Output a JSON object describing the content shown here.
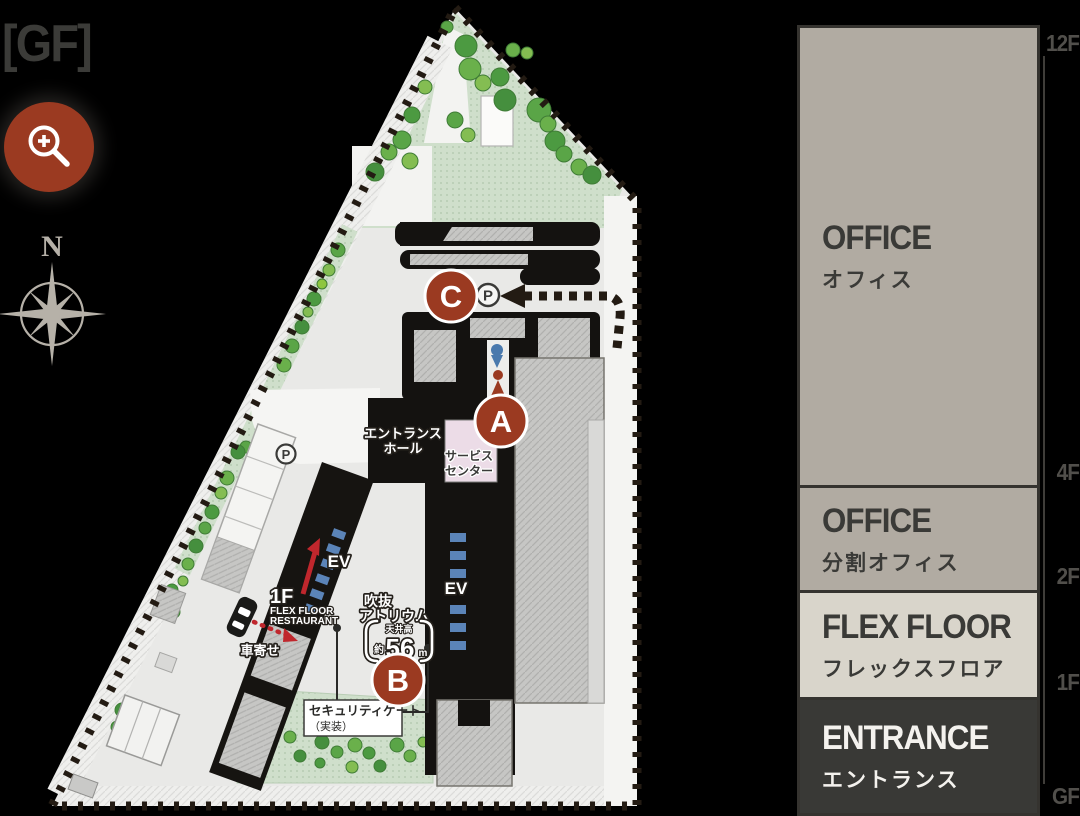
{
  "page": {
    "title": "[GF]"
  },
  "controls": {
    "zoom_button_icon": "magnifier-plus-icon",
    "compass_north": "N"
  },
  "map": {
    "markers": [
      {
        "label": "C"
      },
      {
        "label": "A"
      },
      {
        "label": "B"
      }
    ],
    "parking": {
      "north": "P",
      "west": "P"
    },
    "labels": {
      "entrance_hall_line1": "エントランス",
      "entrance_hall_line2": "ホール",
      "service_center_line1": "サービス",
      "service_center_line2": "センター",
      "ev_left": "EV",
      "ev_right": "EV",
      "restaurant_floor": "1F",
      "restaurant_line1": "FLEX FLOOR",
      "restaurant_line2": "RESTAURANT",
      "atrium_line1": "吹抜",
      "atrium_line2": "アトリウム",
      "ceiling_caption": "天井高",
      "ceiling_prefix": "約",
      "ceiling_value": "56",
      "ceiling_unit": "m",
      "car_drop": "車寄せ",
      "security_gate_line1": "セキュリティゲート",
      "security_gate_line2": "（実装）"
    }
  },
  "sidebar": {
    "floors": [
      {
        "en": "OFFICE",
        "ja": "オフィス"
      },
      {
        "en": "OFFICE",
        "ja": "分割オフィス"
      },
      {
        "en": "FLEX FLOOR",
        "ja": "フレックスフロア"
      },
      {
        "en": "ENTRANCE",
        "ja": "エントランス"
      }
    ],
    "scale": [
      "12F",
      "4F",
      "2F",
      "1F",
      "GF"
    ]
  },
  "colors": {
    "accent_red": "#9b3a21",
    "block_gray": "#b1aba2",
    "block_light": "#d9d5cb",
    "block_dark": "#393936",
    "paving": "#e9e9e7"
  }
}
